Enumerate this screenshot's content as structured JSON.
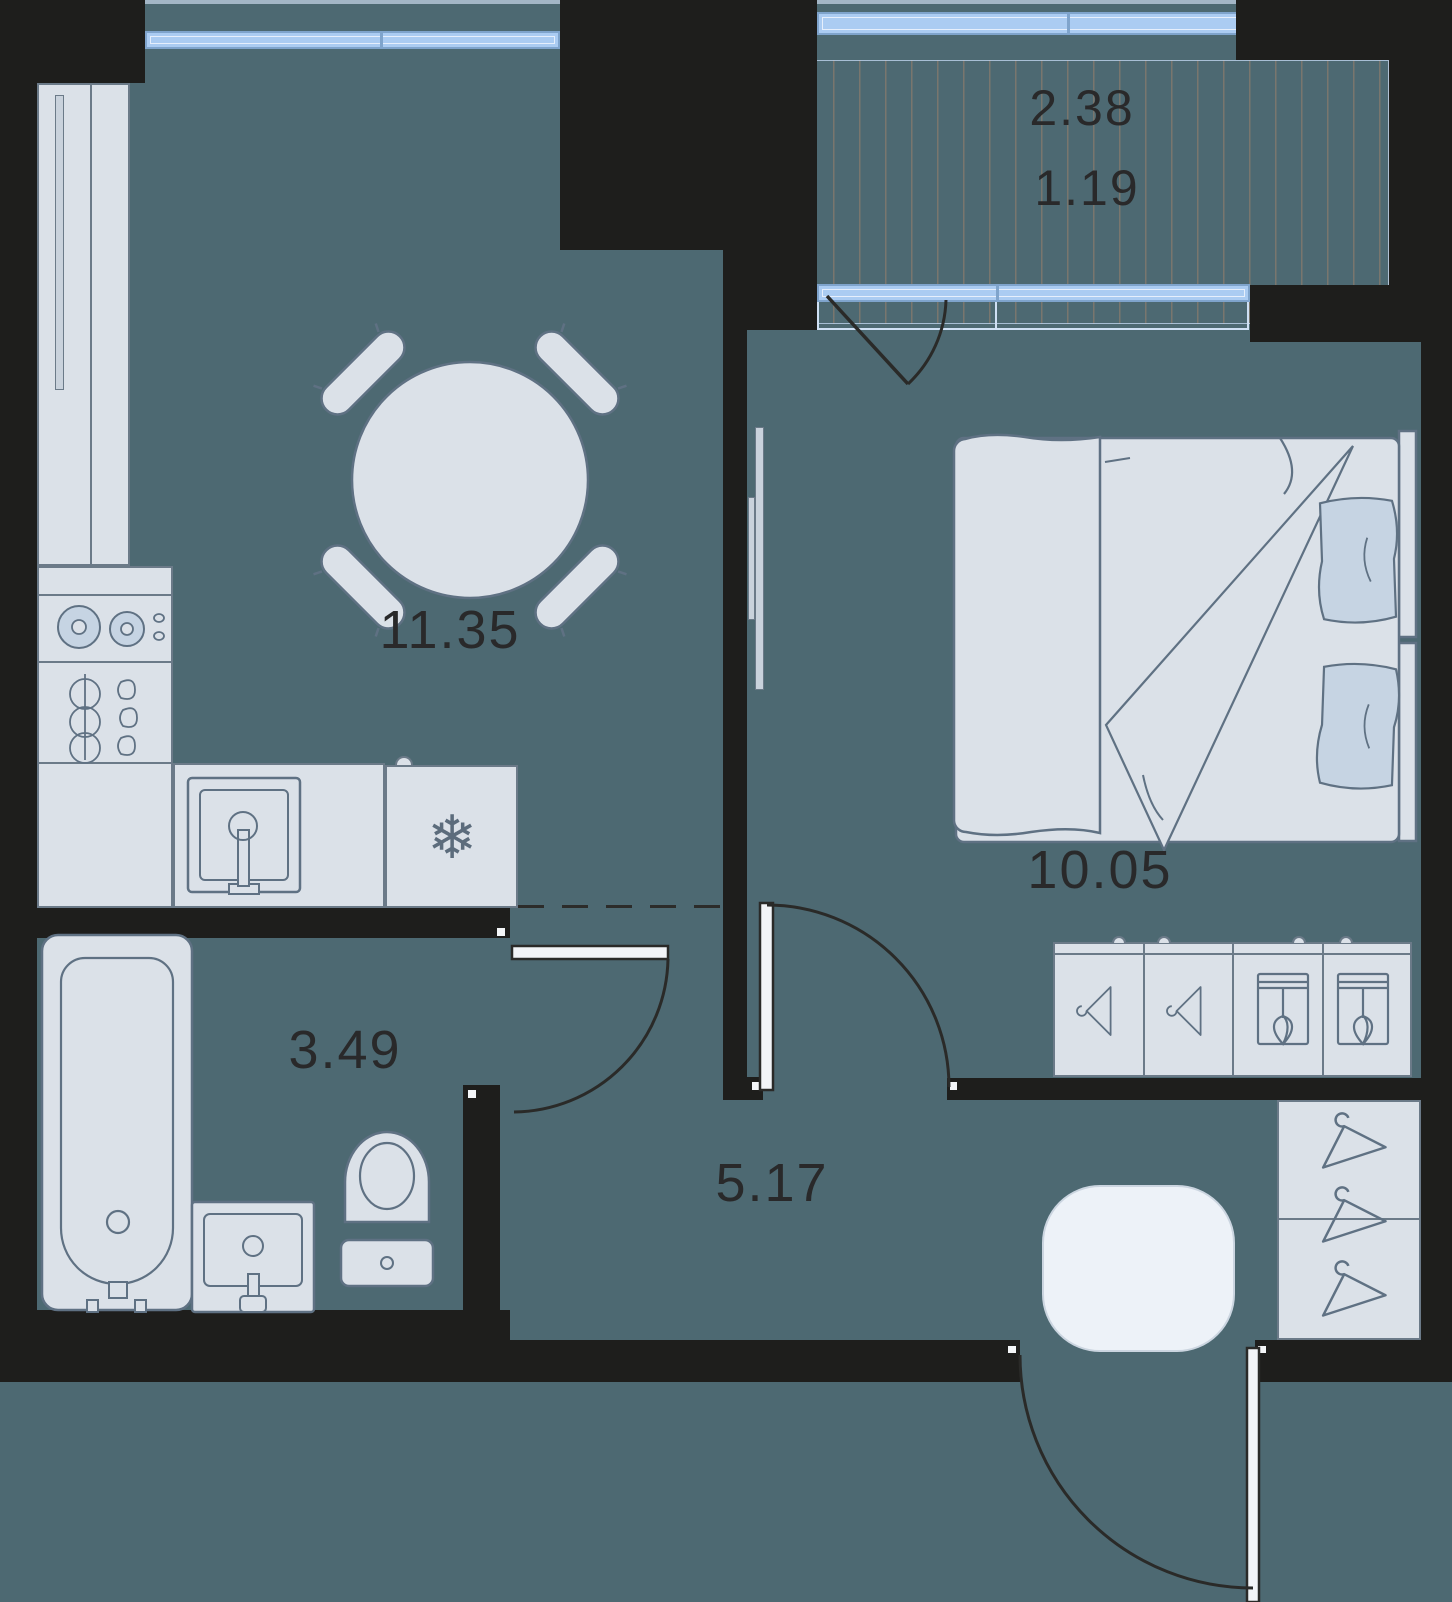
{
  "floor_plan": {
    "type": "apartment-floor-plan",
    "labels": {
      "kitchen_living": "11.35",
      "bedroom": "10.05",
      "bathroom": "3.49",
      "hallway": "5.17",
      "balcony_total": "2.38",
      "balcony_reduced": "1.19"
    },
    "colors": {
      "wall": "#1e1e1c",
      "floor": "#4d6972",
      "furniture_fill": "#dbe1e8",
      "furniture_outline": "#6b7a88",
      "accent_fill": "#c6d4e3",
      "window_glass": "#abccf2",
      "window_frame": "#7fa4cc",
      "rug": "#edf2f8",
      "label_text": "#29292a"
    }
  }
}
